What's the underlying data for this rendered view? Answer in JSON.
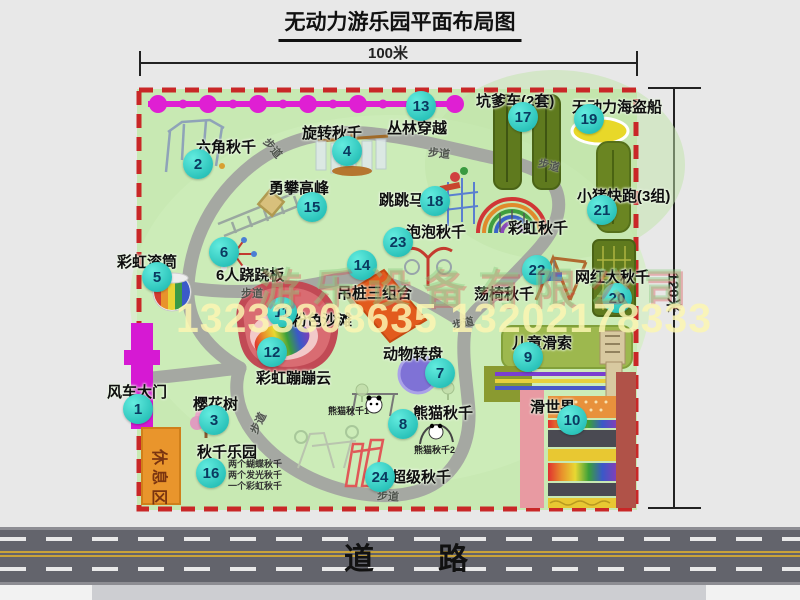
{
  "page": {
    "title": "无动力游乐园平面布局图"
  },
  "dimensions": {
    "width_label": "100米",
    "height_label": "120米"
  },
  "road": {
    "label": "道路"
  },
  "watermark": {
    "company": "游乐设备有限公司",
    "phone": "13233808635 13202178333"
  },
  "walkway_label": "步道",
  "rest_area_label": "休息区",
  "rainbow_swing_label": "彩虹秋千",
  "attractions": [
    {
      "num": "1",
      "label": "风车大门"
    },
    {
      "num": "2",
      "label": "六角秋千"
    },
    {
      "num": "3",
      "label": "樱花树"
    },
    {
      "num": "4",
      "label": "旋转秋千"
    },
    {
      "num": "5",
      "label": "彩虹滚筒"
    },
    {
      "num": "6",
      "label": "6人跷跷板"
    },
    {
      "num": "7",
      "label": "动物转盘"
    },
    {
      "num": "8",
      "label": "熊猫秋千",
      "sub1": "熊猫秋千1",
      "sub2": "熊猫秋千2"
    },
    {
      "num": "9",
      "label": "儿童滑索"
    },
    {
      "num": "10",
      "label": "滑世界"
    },
    {
      "num": "11",
      "label": "粉色沙滩"
    },
    {
      "num": "12",
      "label": "彩虹蹦蹦云"
    },
    {
      "num": "13",
      "label": "丛林穿越"
    },
    {
      "num": "14",
      "label": "吊桩三组合"
    },
    {
      "num": "15",
      "label": "勇攀高峰"
    },
    {
      "num": "16",
      "label": "秋千乐园",
      "notes": [
        "两个蝴蝶秋千",
        "两个发光秋千",
        "一个彩虹秋千"
      ]
    },
    {
      "num": "17",
      "label": "坑爹车(2套)"
    },
    {
      "num": "18",
      "label": "跳跳马"
    },
    {
      "num": "19",
      "label": "无动力海盗船"
    },
    {
      "num": "20",
      "label": "网红大秋千"
    },
    {
      "num": "21",
      "label": "小猪快跑(3组)"
    },
    {
      "num": "22",
      "label": "荡椅秋千"
    },
    {
      "num": "23",
      "label": "泡泡秋千"
    },
    {
      "num": "24",
      "label": "超级秋千"
    }
  ]
}
